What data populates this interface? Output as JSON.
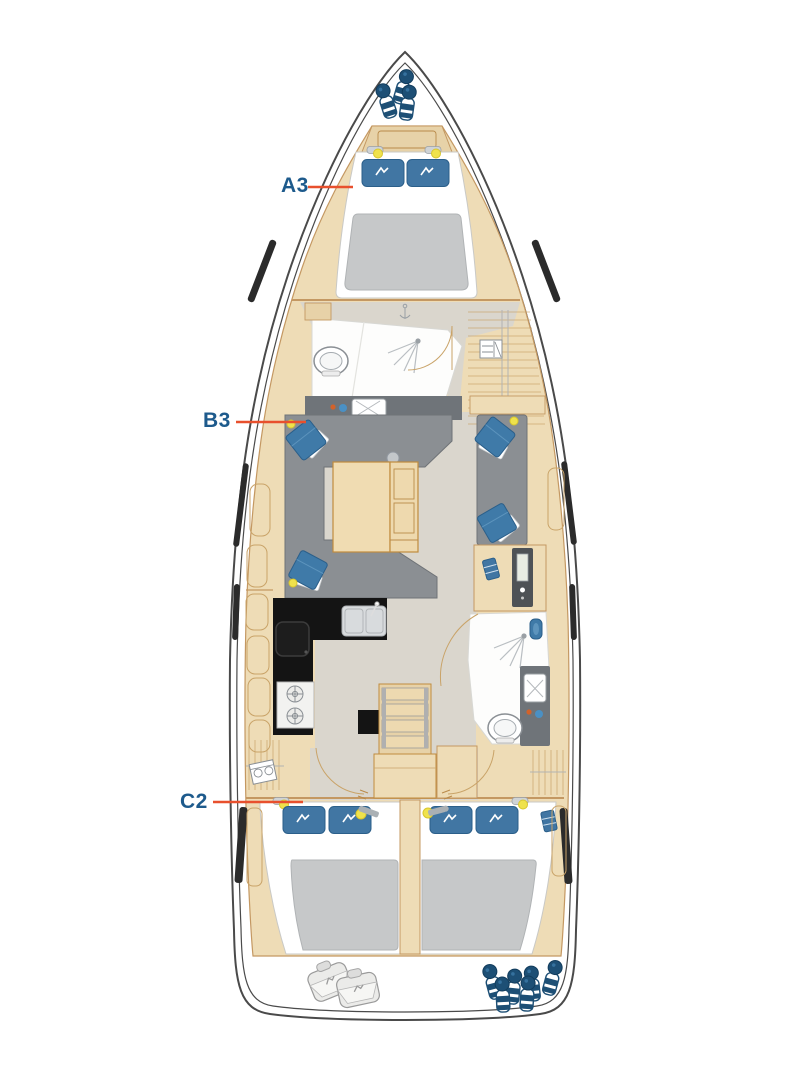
{
  "diagram": {
    "kind": "sailing-yacht-interior-layout-plan",
    "orientation": "bow-top-stern-bottom",
    "labels": [
      {
        "text": "A3",
        "target": "forward-double-cabin"
      },
      {
        "text": "B3",
        "target": "saloon"
      },
      {
        "text": "C2",
        "target": "aft-port-double-cabin"
      }
    ]
  },
  "colors": {
    "label_text": "#1d5a8c",
    "leader_line": "#e8502d",
    "hull_outline": "#4a4a4a",
    "deck_wood": "#eedcb6",
    "wood_trim": "#c49862",
    "sole_gray": "#dad6cd",
    "upholstery_gray": "#8b8f93",
    "cushion_blue": "#3f7aa8",
    "pillow_blue": "#4176a3",
    "mattress_gray": "#c6c8c9",
    "galley_counter_black": "#141414",
    "counter_gray": "#6f7479",
    "accent_yellow": "#efe24c",
    "fender_blue": "#1d4f75",
    "tap_orange": "#d2622a",
    "tap_blue": "#4a90c4"
  },
  "icons": {
    "fender": "fender-icon",
    "fender_bag": "fender-bag-icon",
    "pillow": "pillow-icon",
    "cushion": "cushion-icon",
    "reading_light": "reading-light-icon",
    "toilet": "toilet-icon",
    "sink": "sink-icon",
    "basin": "basin-icon",
    "shower": "shower-icon",
    "stove": "stove-icon",
    "burner": "burner-icon",
    "stairs": "companionway-stairs-icon",
    "hull_window": "hull-window-icon",
    "book": "book-icon",
    "vent_grid": "vent-grid-icon",
    "laundry": "laundry-icon",
    "table": "saloon-table",
    "anchor_point": "deck-fitting-icon"
  }
}
